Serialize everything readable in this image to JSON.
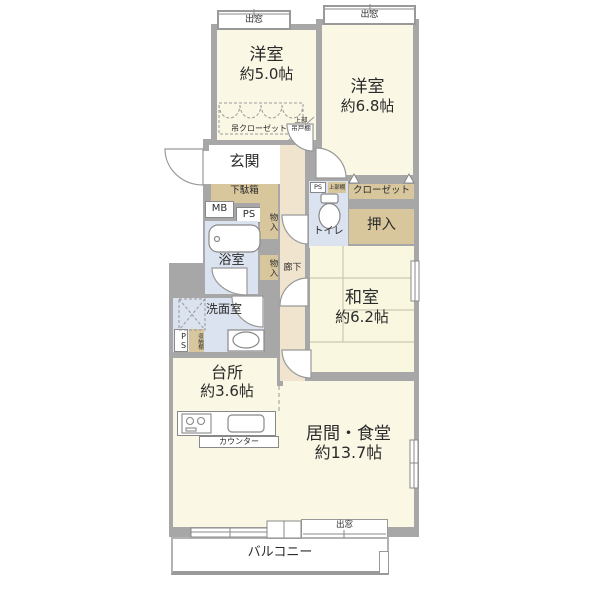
{
  "plan": {
    "bay1": "出窓",
    "bay2": "出窓",
    "bay3": "出窓",
    "rooms": {
      "western1": {
        "name": "洋室",
        "size": "約5.0帖"
      },
      "western2": {
        "name": "洋室",
        "size": "約6.8帖"
      },
      "japanese": {
        "name": "和室",
        "size": "約6.2帖"
      },
      "kitchen": {
        "name": "台所",
        "size": "約3.6帖"
      },
      "living": {
        "name": "居間・食堂",
        "size": "約13.7帖"
      },
      "entrance": "玄関",
      "bath": "浴室",
      "washroom": "洗面室",
      "toilet": "トイレ",
      "hallway": "廊下",
      "balcony": "バルコニー"
    },
    "storage": {
      "shoe_cabinet": "下駄箱",
      "closet": "クローゼット",
      "oshiire": "押入",
      "hanging_closet": "吊クローゼット",
      "upper_cupboard_line1": "上部",
      "upper_cupboard_line2": "吊戸棚",
      "upper_shelf": "上部棚",
      "storage_shelf": "収納棚",
      "storage1": "物入",
      "storage2": "物入"
    },
    "utility": {
      "mb": "MB",
      "ps1": "PS",
      "ps2": "PS",
      "ps3": "PS"
    },
    "counter": "カウンター"
  },
  "colors": {
    "wall": "#a7a7a7",
    "room_cream": "#faf7e5",
    "tatami_cream": "#f9f7e0",
    "corridor_beige": "#f0e4cf",
    "storage_tan": "#d8c79c",
    "wet_blue": "#dce3f0",
    "fixture_outline": "#888888"
  }
}
